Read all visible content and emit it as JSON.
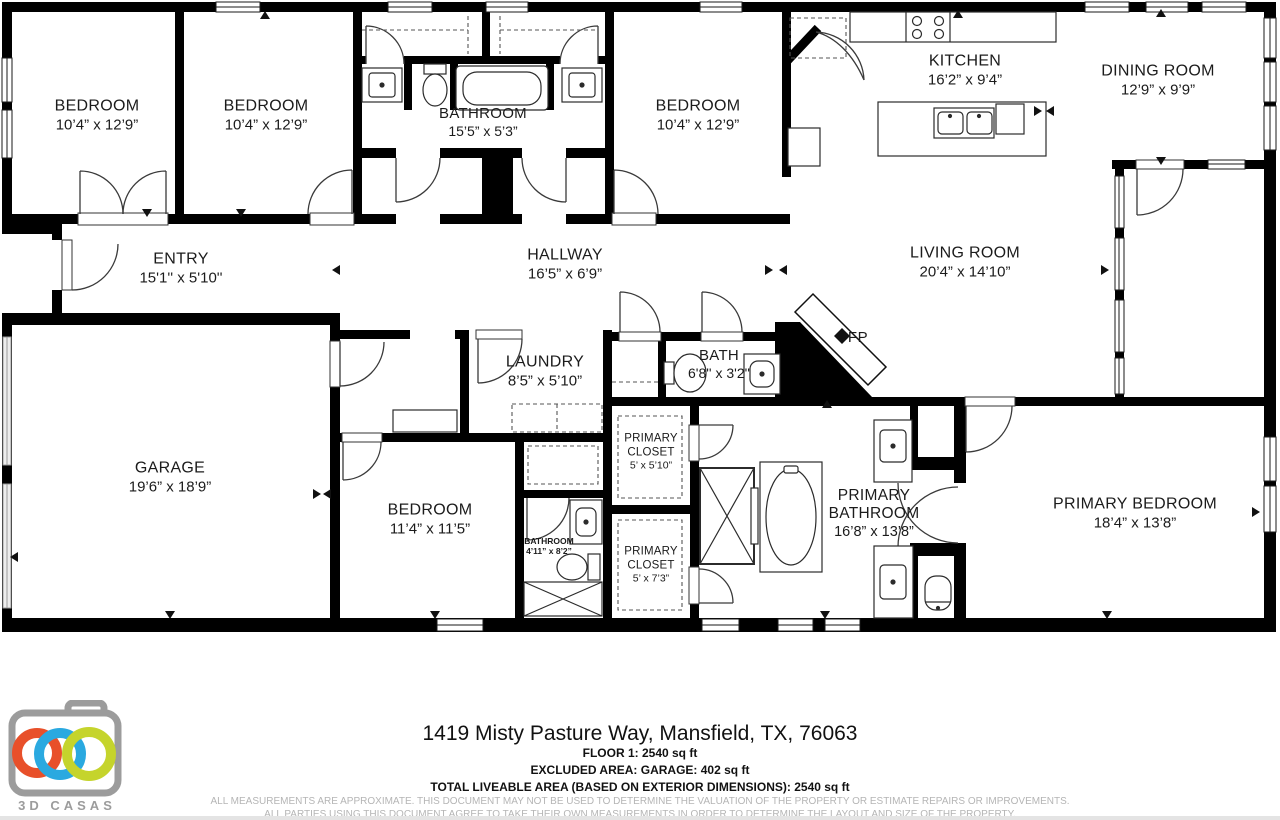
{
  "plan": {
    "rooms": {
      "bedroom1": {
        "name": "BEDROOM",
        "dims": "10’4” x 12’9”"
      },
      "bedroom2": {
        "name": "BEDROOM",
        "dims": "10’4” x 12’9”"
      },
      "hall_bathroom": {
        "name": "BATHROOM",
        "dims": "15’5” x 5’3”"
      },
      "bedroom3": {
        "name": "BEDROOM",
        "dims": "10’4” x 12’9”"
      },
      "kitchen": {
        "name": "KITCHEN",
        "dims": "16’2” x 9’4”"
      },
      "dining_room": {
        "name": "DINING ROOM",
        "dims": "12’9” x 9’9”"
      },
      "entry": {
        "name": "ENTRY",
        "dims": "15'1'' x 5'10''"
      },
      "hallway": {
        "name": "HALLWAY",
        "dims": "16’5” x 6’9”"
      },
      "living_room": {
        "name": "LIVING ROOM",
        "dims": "20’4” x 14’10”"
      },
      "laundry": {
        "name": "LAUNDRY",
        "dims": "8’5” x 5’10”"
      },
      "bath": {
        "name": "BATH",
        "dims": "6'8'' x 3'2''"
      },
      "fireplace": {
        "name": "FP"
      },
      "garage": {
        "name": "GARAGE",
        "dims": "19’6” x 18’9”"
      },
      "bedroom4": {
        "name": "BEDROOM",
        "dims": "11’4” x 11’5”"
      },
      "small_bathroom": {
        "name": "BATHROOM",
        "dims": "4’11” x 8’2”"
      },
      "primary_closet1": {
        "name": "PRIMARY CLOSET",
        "dims": "5’ x 5’10”"
      },
      "primary_closet2": {
        "name": "PRIMARY CLOSET",
        "dims": "5’ x 7’3”"
      },
      "primary_bathroom": {
        "name": "PRIMARY BATHROOM",
        "dims": "16’8” x 13’8”"
      },
      "primary_bedroom": {
        "name": "PRIMARY BEDROOM",
        "dims": "18’4” x 13’8”"
      }
    }
  },
  "footer": {
    "address": "1419 Misty Pasture Way, Mansfield, TX, 76063",
    "floor_area": "FLOOR 1: 2540 sq ft",
    "excluded_area": "EXCLUDED AREA: GARAGE: 402 sq ft",
    "total_area": "TOTAL LIVEABLE AREA (BASED ON EXTERIOR DIMENSIONS): 2540 sq ft",
    "disclaimer1": "ALL MEASUREMENTS ARE APPROXIMATE. THIS DOCUMENT MAY NOT BE USED TO DETERMINE THE VALUATION OF THE PROPERTY OR ESTIMATE REPAIRS OR IMPROVEMENTS.",
    "disclaimer2": "ALL PARTIES USING THIS DOCUMENT AGREE TO TAKE THEIR OWN MEASUREMENTS IN ORDER TO DETERMINE THE LAYOUT AND SIZE OF THE PROPERTY."
  },
  "logo": {
    "brand": "3D CASAS"
  },
  "colors": {
    "wall": "#000000",
    "accent_orange": "#e8502a",
    "accent_blue": "#2aa9e0",
    "accent_green": "#c5d42c",
    "logo_gray": "#9c9c9c",
    "disclaimer_gray": "#b5b5b5"
  }
}
